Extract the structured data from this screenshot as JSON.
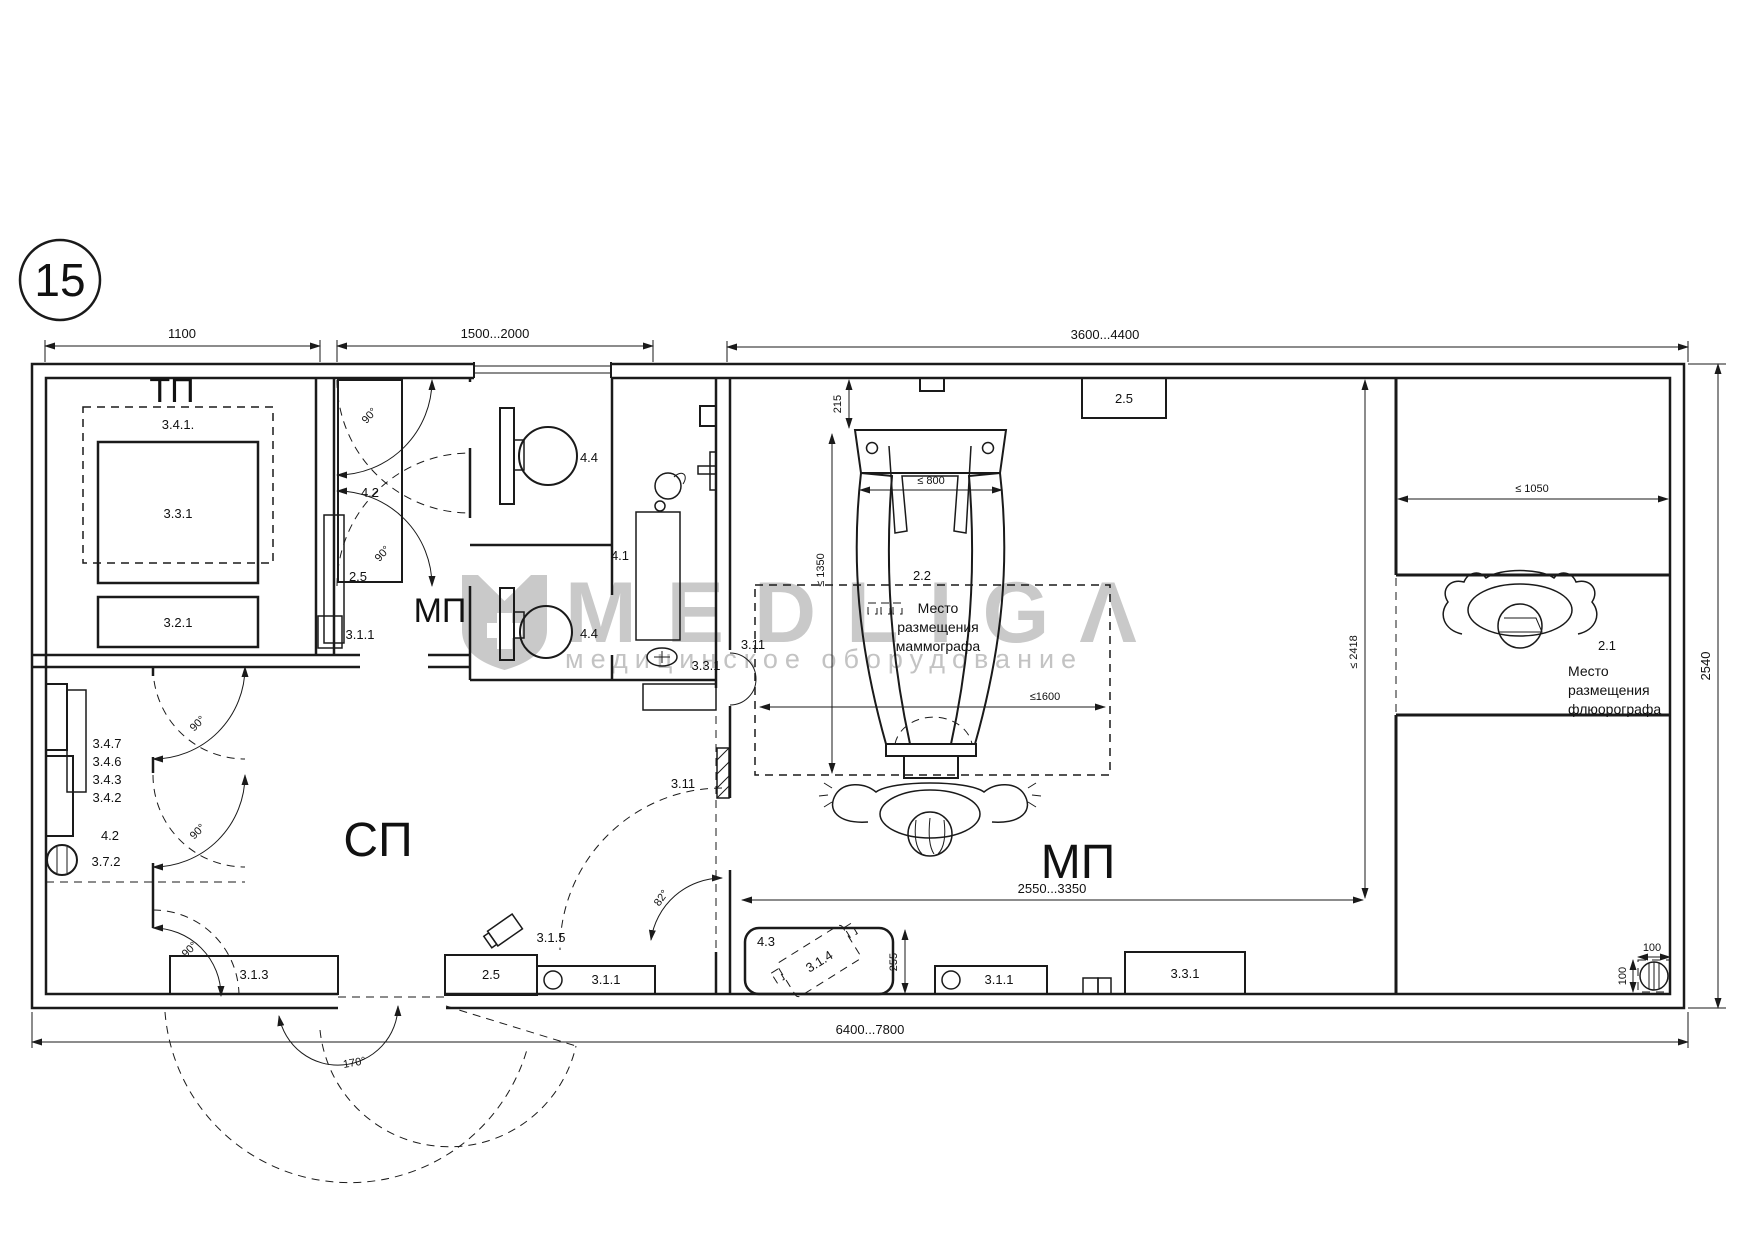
{
  "sheet": {
    "number": "15"
  },
  "watermark": {
    "brand": "MEDLIGΛ",
    "tagline": "медицинское оборудование"
  },
  "rooms": {
    "tp": "ТП",
    "san": "МП",
    "sp": "СП",
    "mp": "МП"
  },
  "dims": {
    "top_left": "1100",
    "top_mid": "1500...2000",
    "top_right": "3600...4400",
    "right_side": "2540",
    "bottom": "6400...7800",
    "mam_top_offset": "215",
    "mam_width": "≤ 800",
    "mam_height": "≤ 1350",
    "mam_zone_width": "≤1600",
    "mp_zone": "2550...3350",
    "mp_depth": "≤ 2418",
    "fl_width": "≤ 1050",
    "bench_depth": "255",
    "drain_width": "100",
    "drain_height": "100"
  },
  "angles": {
    "deg90": "90°",
    "deg82": "82°",
    "deg170": "170°"
  },
  "equipment": {
    "tp_341": "3.4.1.",
    "tp_331": "3.3.1",
    "tp_321": "3.2.1",
    "vest_42": "4.2",
    "vest_25": "2.5",
    "vest_311": "3.1.1",
    "wc_44_top": "4.4",
    "wc_44_bottom": "4.4",
    "shower_41": "4.1",
    "shower_331": "3.3.1",
    "rack_347": "3.4.7",
    "rack_346": "3.4.6",
    "rack_343": "3.4.3",
    "rack_342": "3.4.2",
    "sp_42": "4.2",
    "sp_372": "3.7.2",
    "sp_313": "3.1.3",
    "sp_25": "2.5",
    "sp_315": "3.1.5",
    "sp_311": "3.1.1",
    "mam_22": "2.2",
    "mp_25": "2.5",
    "door_311_top": "3.11",
    "door_311_bottom": "3.11",
    "mp_43": "4.3",
    "mp_314": "3.1.4",
    "mp_311": "3.1.1",
    "mp_331": "3.3.1",
    "fl_21": "2.1"
  },
  "notes": {
    "mammograph": {
      "l1": "Место",
      "l2": "размещения",
      "l3": "маммографа"
    },
    "fluorograph": {
      "l1": "Место",
      "l2": "размещения",
      "l3": "флюорографа"
    }
  }
}
